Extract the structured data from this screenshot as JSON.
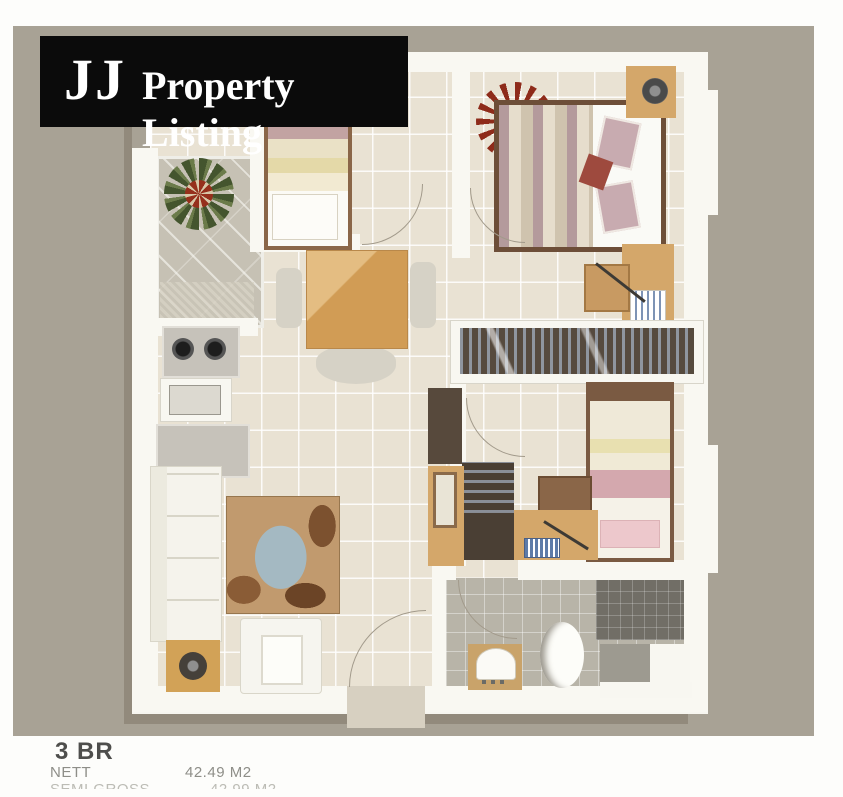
{
  "banner": {
    "brand": "JJ",
    "title": "Property Listing",
    "bg_color": "#0b0b0b",
    "text_color": "#ffffff"
  },
  "footer": {
    "unit_type": "3 BR",
    "rows": [
      {
        "label": "NETT",
        "value": "42.49 M2",
        "clipped": false
      },
      {
        "label": "SEMI GROSS",
        "value": "42.99 M2",
        "clipped": true
      }
    ]
  },
  "floorplan": {
    "type": "apartment-floor-plan-render",
    "rooms": [
      "balcony",
      "bedroom-3",
      "master-bedroom",
      "bedroom-2",
      "kitchen",
      "dining-area",
      "living-room",
      "bathroom",
      "entry"
    ],
    "furniture": [
      "plant",
      "single-bed",
      "double-bed",
      "wardrobe",
      "bookshelf",
      "desk",
      "desk-chair",
      "dining-table",
      "dining-chairs",
      "sofa",
      "armchair",
      "area-rug",
      "side-table",
      "stove",
      "kitchen-sink",
      "refrigerator",
      "bathroom-sink",
      "toilet",
      "shower"
    ],
    "colors": {
      "background_mat": "#a8a295",
      "walls": "#f9f8f2",
      "floor_tile": "#e9e2d3",
      "balcony_tile": "#c6c1b4",
      "bathroom_tile": "#b8b4a8",
      "wood_accent": "#d4a76a",
      "dark_wood": "#57493c"
    }
  }
}
